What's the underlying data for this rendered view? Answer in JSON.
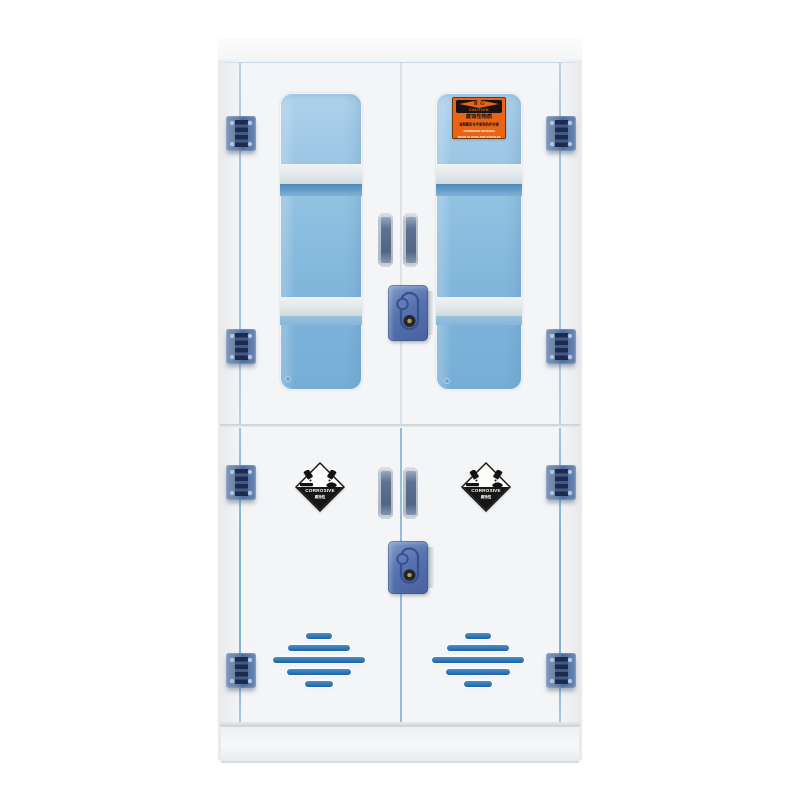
{
  "caution_label": {
    "header_cn": "当 心",
    "header_en": "CAUTION",
    "line1_cn": "腐蚀性物质",
    "line2_cn": "请佩戴防化手套和防护目镜",
    "line1_en": "CORROSIVE MATERIAL",
    "line2_en": "WEAR GLOVES AND GOGGLES"
  },
  "corrosive_label": {
    "title": "CORROSIVE",
    "subtitle": "腐蚀性"
  },
  "colors": {
    "cabinet_white": "#f4f5f6",
    "glass_top": "#aed2ec",
    "glass_bottom": "#76aed7",
    "shelf_bar": "#e2e8ea",
    "shelf_strip": "#4e88ba",
    "hinge_dark": "#1b2a4d",
    "lock_blue": "#5673ae",
    "vent_blue": "#1d62a6",
    "label_orange": "#e96417",
    "label_black": "#171310"
  }
}
